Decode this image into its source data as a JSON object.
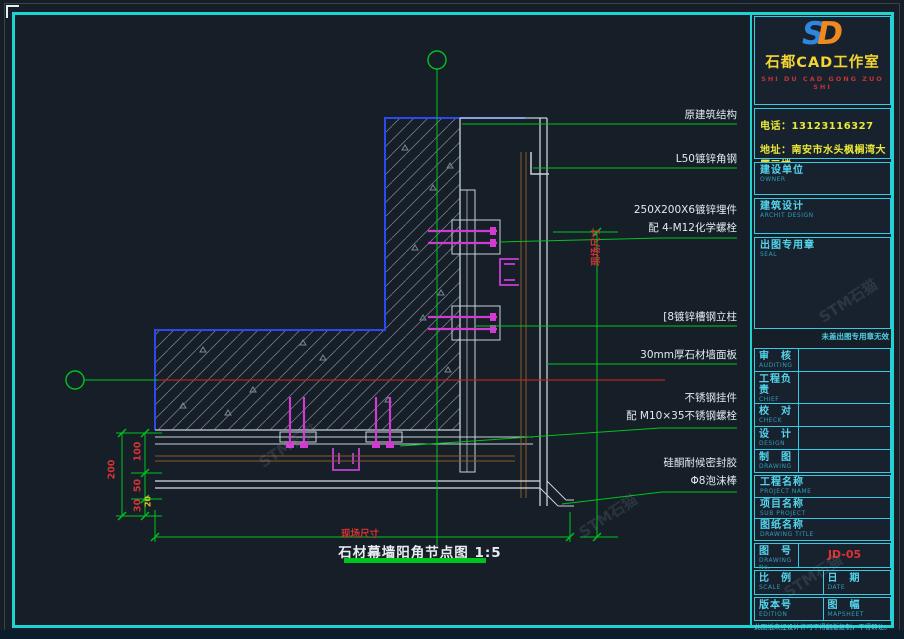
{
  "window": {
    "watermark": "STM石猫"
  },
  "logo": {
    "mark_left": "S",
    "mark_right": "D",
    "studio_name": "石都CAD工作室",
    "pinyin": "SHI DU CAD GONG ZUO SHI"
  },
  "contact": {
    "phone": "电话：13123116327",
    "address": "地址：南安市水头枫榈湾大厦三楼"
  },
  "sections": {
    "owner": {
      "cn": "建设单位",
      "en": "OWNER"
    },
    "architect": {
      "cn": "建筑设计",
      "en": "ARCHIT DESIGN"
    },
    "seal": {
      "cn": "出图专用章",
      "en": "SEAL",
      "note": "未盖出图专用章无效"
    }
  },
  "personnel_rows": [
    {
      "cn": "审　核",
      "en": "AUDITING"
    },
    {
      "cn": "工程负责",
      "en": "CHIEF"
    },
    {
      "cn": "校　对",
      "en": "CHECK"
    },
    {
      "cn": "设　计",
      "en": "DESIGN"
    },
    {
      "cn": "制　图",
      "en": "DRAWING"
    }
  ],
  "name_rows": [
    {
      "cn": "工程名称",
      "en": "PROJECT NAME"
    },
    {
      "cn": "项目名称",
      "en": "SUB PROJECT"
    },
    {
      "cn": "图纸名称",
      "en": "DRAWING TITLE"
    }
  ],
  "drawing_no": {
    "cn": "图　号",
    "en": "DRAWING No.",
    "value": "JD-05"
  },
  "meta_rows": {
    "scale": {
      "cn": "比　例",
      "en": "SCALE"
    },
    "date": {
      "cn": "日　期",
      "en": "DATE"
    },
    "edition": {
      "cn": "版本号",
      "en": "EDITION"
    },
    "sheet": {
      "cn": "图　幅",
      "en": "MAPSHEET"
    }
  },
  "footer_note": "此图纸未经设计许可不得翻版复制，不得转让。",
  "annotations": [
    {
      "line1": "原建筑结构",
      "line2": ""
    },
    {
      "line1": "L50镀锌角钢",
      "line2": ""
    },
    {
      "line1": "250X200X6镀锌埋件",
      "line2": "配 4-M12化学螺栓"
    },
    {
      "line1": "[8镀锌槽钢立柱",
      "line2": ""
    },
    {
      "line1": "30mm厚石材墙面板",
      "line2": ""
    },
    {
      "line1": "不锈钢挂件",
      "line2": "配 M10×35不锈钢螺栓"
    },
    {
      "line1": "硅酮耐候密封胶",
      "line2": "Φ8泡沫棒"
    }
  ],
  "dimensions": {
    "total": "200",
    "seg1": "100",
    "seg2": "50",
    "seg3": "30",
    "seg4": "20",
    "site_dim_h": "现场尺寸",
    "site_dim_v": "现场尺寸"
  },
  "title_bar": {
    "text": "石材幕墙阳角节点图",
    "scale": "1:5"
  },
  "colors": {
    "frame_cyan": "#1fd3d3",
    "axis_green": "#00c41e",
    "dim_red": "#d03434",
    "bolt_magenta": "#d23ad2",
    "concrete_blue": "#2b49f0",
    "highlight_yellow": "#e8e838"
  }
}
